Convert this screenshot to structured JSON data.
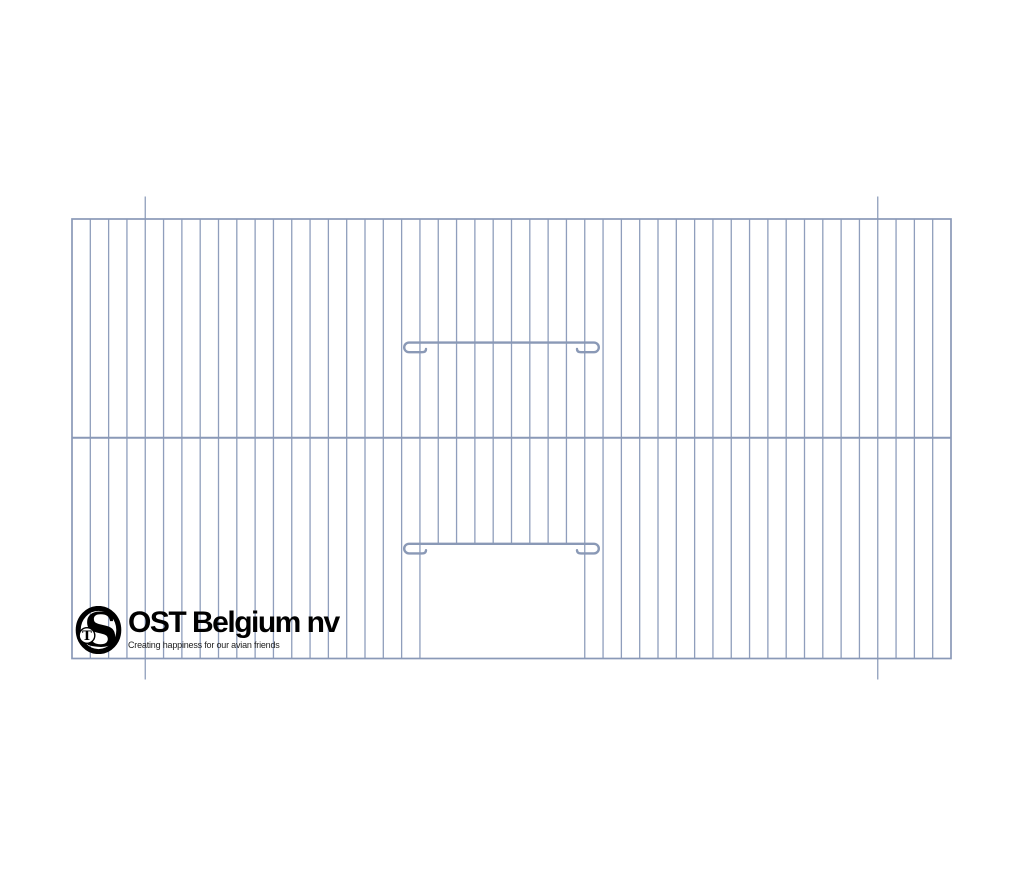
{
  "canvas": {
    "width": 1024,
    "height": 878,
    "background": "#ffffff"
  },
  "drawing": {
    "subject": "bird-cage-front-panel-wire-diagram",
    "wire_color": "#8f9ebc",
    "frame_color": "#8a99b7",
    "bar_color": "#8a99b6",
    "frame": {
      "x1": 72,
      "y1": 219,
      "x2": 951,
      "y2": 658.5
    },
    "grid": {
      "gaps": 48,
      "interior_wires": 47
    },
    "middle_wire_y": 437.8,
    "door": {
      "left_wire": 19,
      "right_wire": 28,
      "opening_top_y": 543.8
    },
    "slider_bars": [
      {
        "y": 342.6,
        "x_left": 409,
        "x_right": 594
      },
      {
        "y": 543.8,
        "x_left": 409,
        "x_right": 594
      }
    ],
    "ticks": {
      "wires": [
        4,
        44
      ],
      "top_extension": 22.5,
      "bottom_extension": 21
    }
  },
  "logo": {
    "monogram": {
      "o": "O",
      "s": "S",
      "t": "T"
    },
    "company_name": "OST Belgium nv",
    "tagline": "Creating happiness for our avian friends",
    "text_color": "#000000",
    "tagline_color": "#222222"
  }
}
